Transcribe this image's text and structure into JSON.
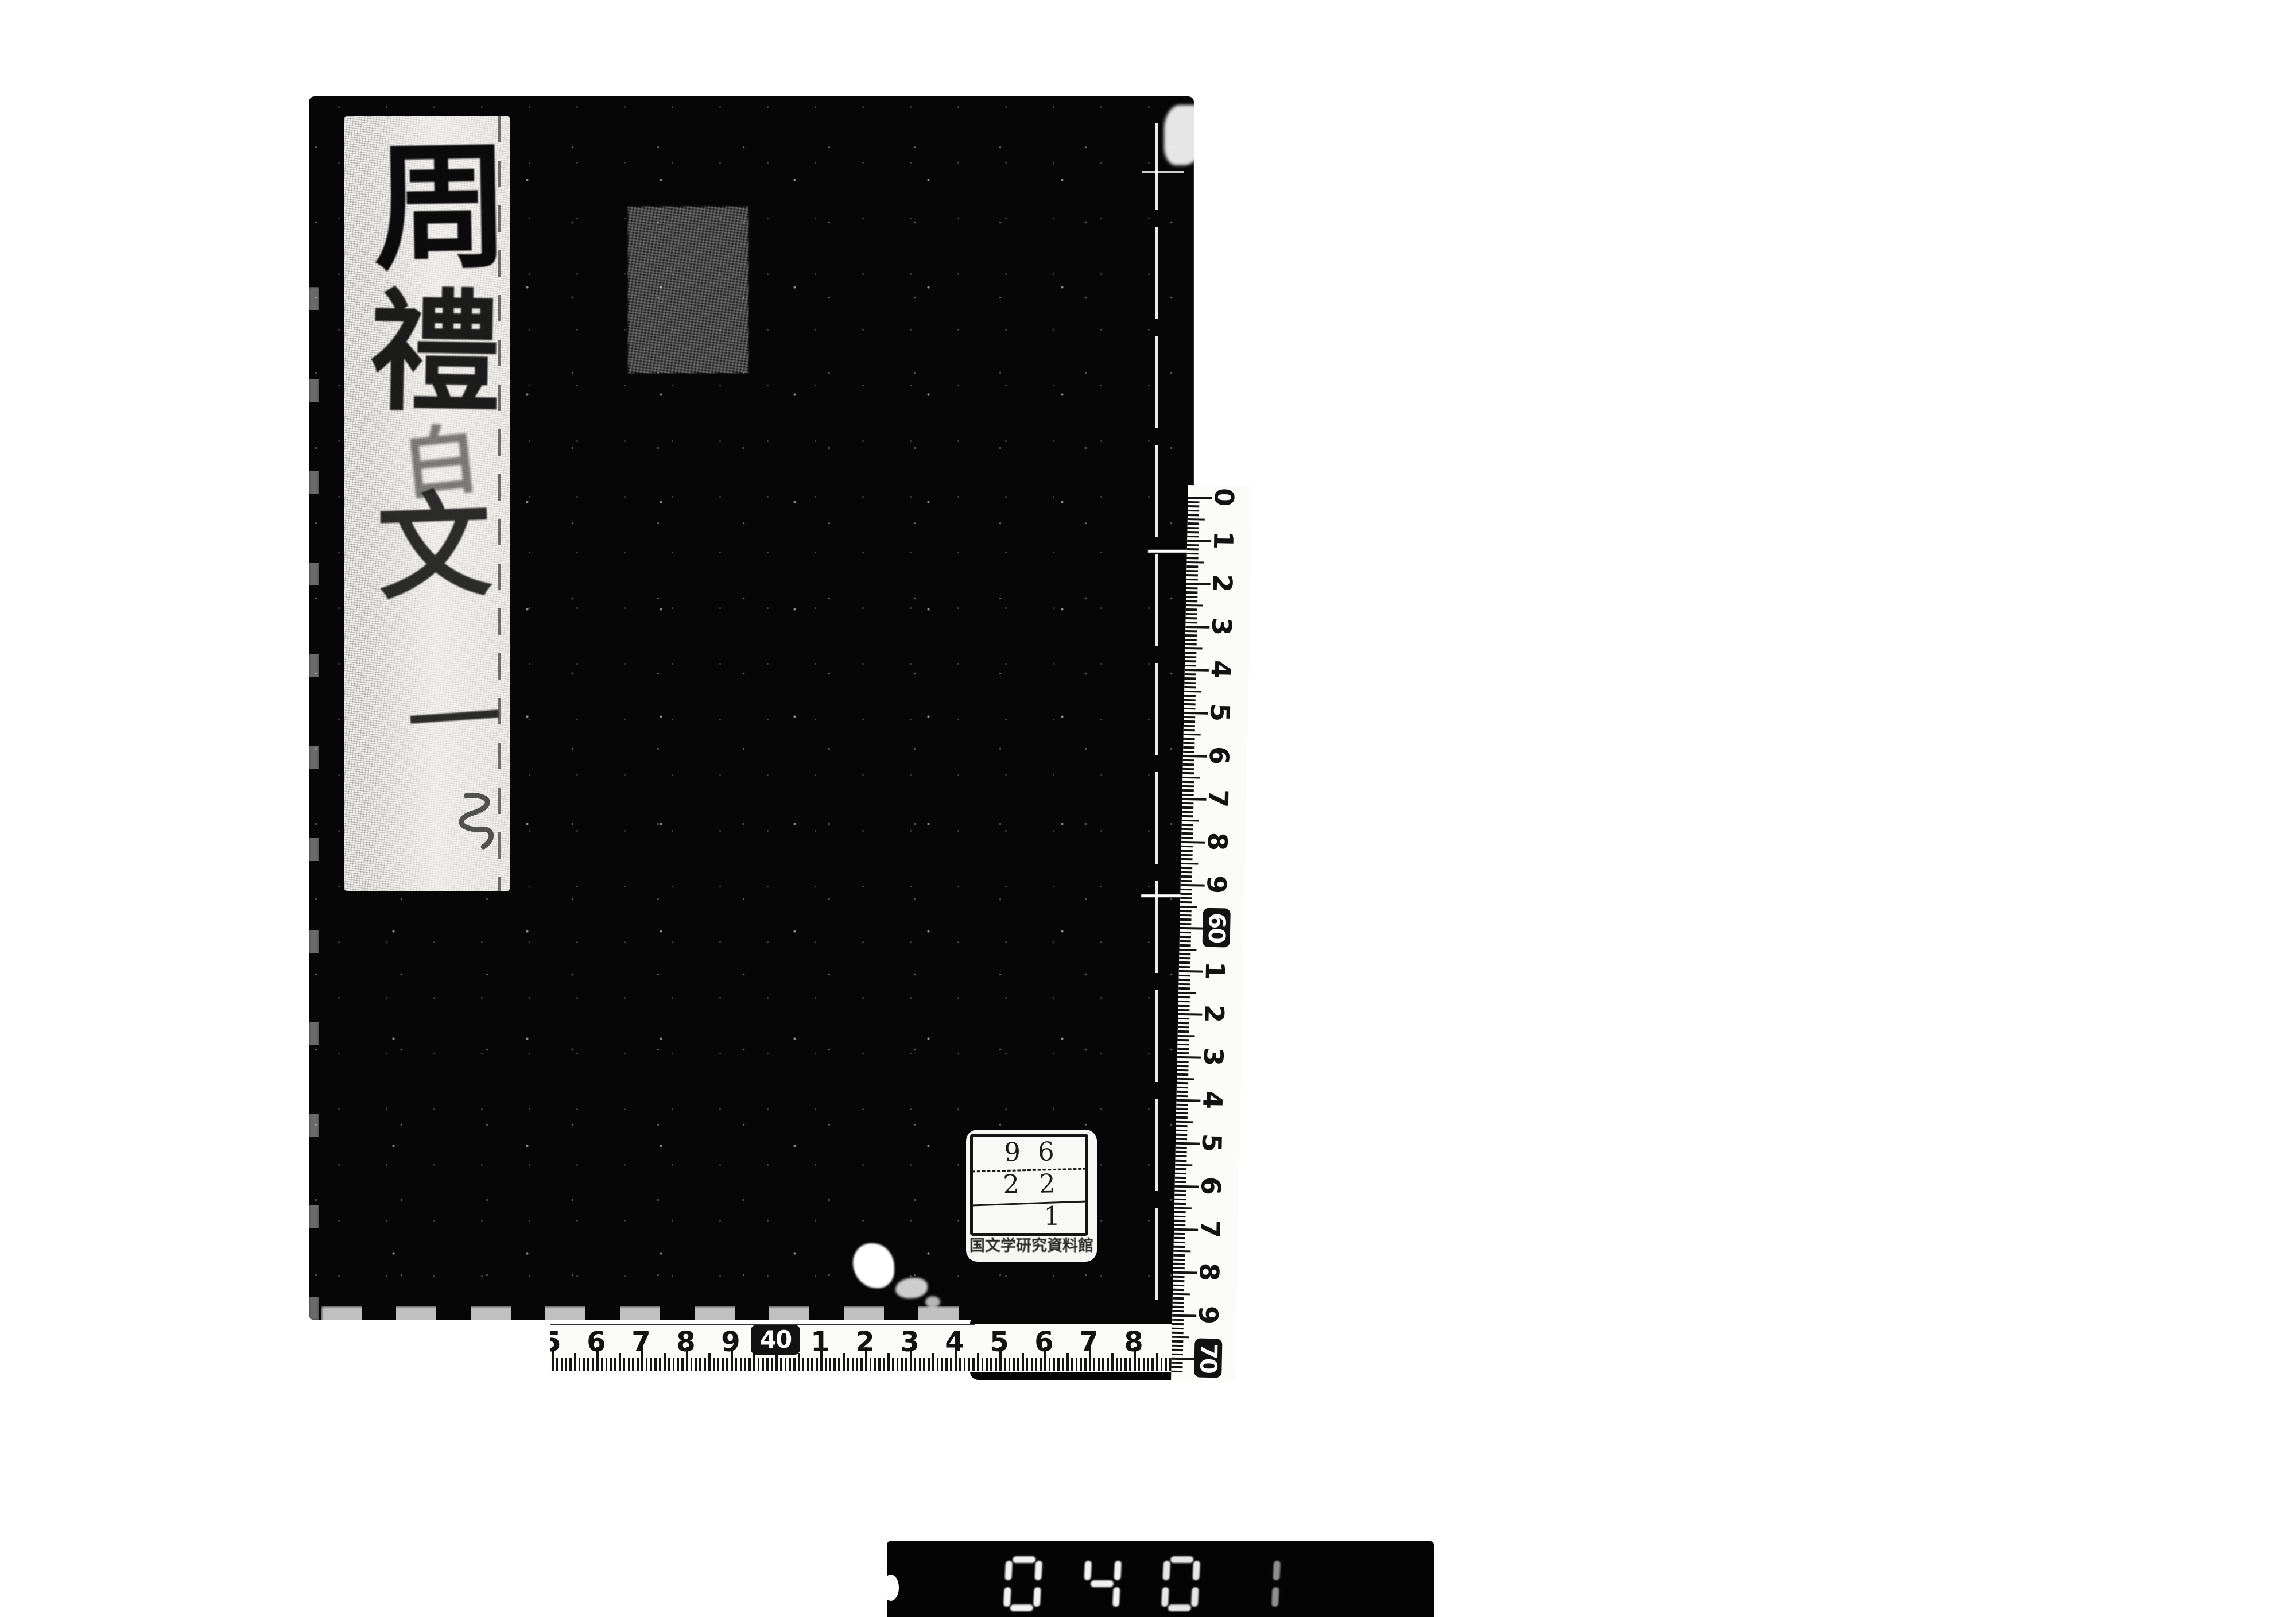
{
  "document_kind": "scanned-book-cover",
  "colors": {
    "page_background": "#ffffff",
    "book_cover": "#060606",
    "label_paper": "#f3f2ef",
    "ink": "#121212"
  },
  "book": {
    "title_label": {
      "title": "周禮白文",
      "title_chars": [
        "周",
        "禮",
        "白",
        "文"
      ],
      "volume_mark": "一"
    }
  },
  "library_stamp": {
    "rows": [
      {
        "value": "96"
      },
      {
        "value": "22"
      },
      {
        "value": "1"
      }
    ],
    "caption": "国文学研究資料館"
  },
  "rulers": {
    "unit": "cm",
    "vertical_marks": [
      {
        "label": "0"
      },
      {
        "label": "1"
      },
      {
        "label": "2"
      },
      {
        "label": "3"
      },
      {
        "label": "4"
      },
      {
        "label": "5"
      },
      {
        "label": "6"
      },
      {
        "label": "7"
      },
      {
        "label": "8"
      },
      {
        "label": "9"
      },
      {
        "label": "60",
        "boxed": true
      },
      {
        "label": "1"
      },
      {
        "label": "2"
      },
      {
        "label": "3"
      },
      {
        "label": "4"
      },
      {
        "label": "5"
      },
      {
        "label": "6"
      },
      {
        "label": "7"
      },
      {
        "label": "8"
      },
      {
        "label": "9"
      },
      {
        "label": "70",
        "boxed": true
      }
    ],
    "horizontal_marks": [
      {
        "label": "5"
      },
      {
        "label": "6"
      },
      {
        "label": "7"
      },
      {
        "label": "8"
      },
      {
        "label": "9"
      },
      {
        "label": "40",
        "boxed": true
      },
      {
        "label": "1"
      },
      {
        "label": "2"
      },
      {
        "label": "3"
      },
      {
        "label": "4"
      },
      {
        "label": "5"
      },
      {
        "label": "6"
      },
      {
        "label": "7"
      },
      {
        "label": "8"
      }
    ]
  },
  "frame_counter": {
    "digits": [
      "0",
      "4",
      "0",
      "1"
    ],
    "value": "0401"
  }
}
